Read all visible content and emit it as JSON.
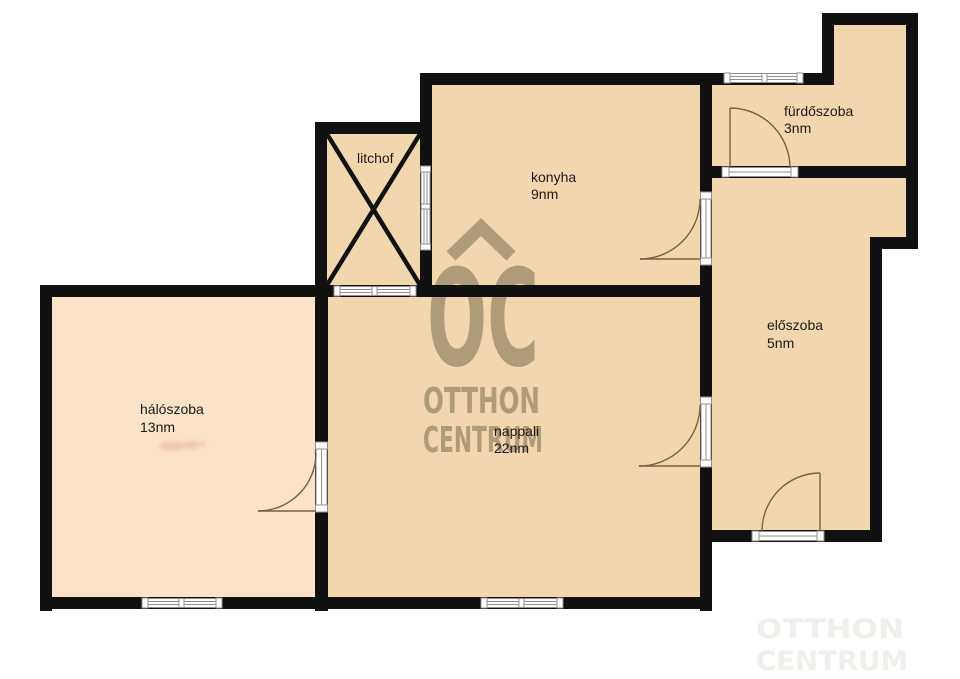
{
  "plan": {
    "background": "#ffffff",
    "wall_color": "#111111",
    "floor_color": "#f2d7ae",
    "bedroom_floor_color": "#fbe3c8",
    "window_color": "#8f8f8f",
    "door_color": "#7d5d3f",
    "label_color": "#1a1a1a",
    "watermark_color": "#a3916f"
  },
  "rooms": [
    {
      "id": "haloszoba",
      "label": "hálószoba",
      "area": "13nm"
    },
    {
      "id": "nappali",
      "label": "nappali",
      "area": "22nm"
    },
    {
      "id": "konyha",
      "label": "konyha",
      "area": "9nm"
    },
    {
      "id": "litchof",
      "label": "litchof",
      "area": ""
    },
    {
      "id": "furdoszoba",
      "label": "fürdőszoba",
      "area": "3nm"
    },
    {
      "id": "eloszoba",
      "label": "előszoba",
      "area": "5nm"
    }
  ],
  "watermark": {
    "logo_text": "OC",
    "brand_line1": "OTTHON",
    "brand_line2": "CENTRUM",
    "ghost_line1": "OTTHON",
    "ghost_line2": "CENTRUM"
  }
}
